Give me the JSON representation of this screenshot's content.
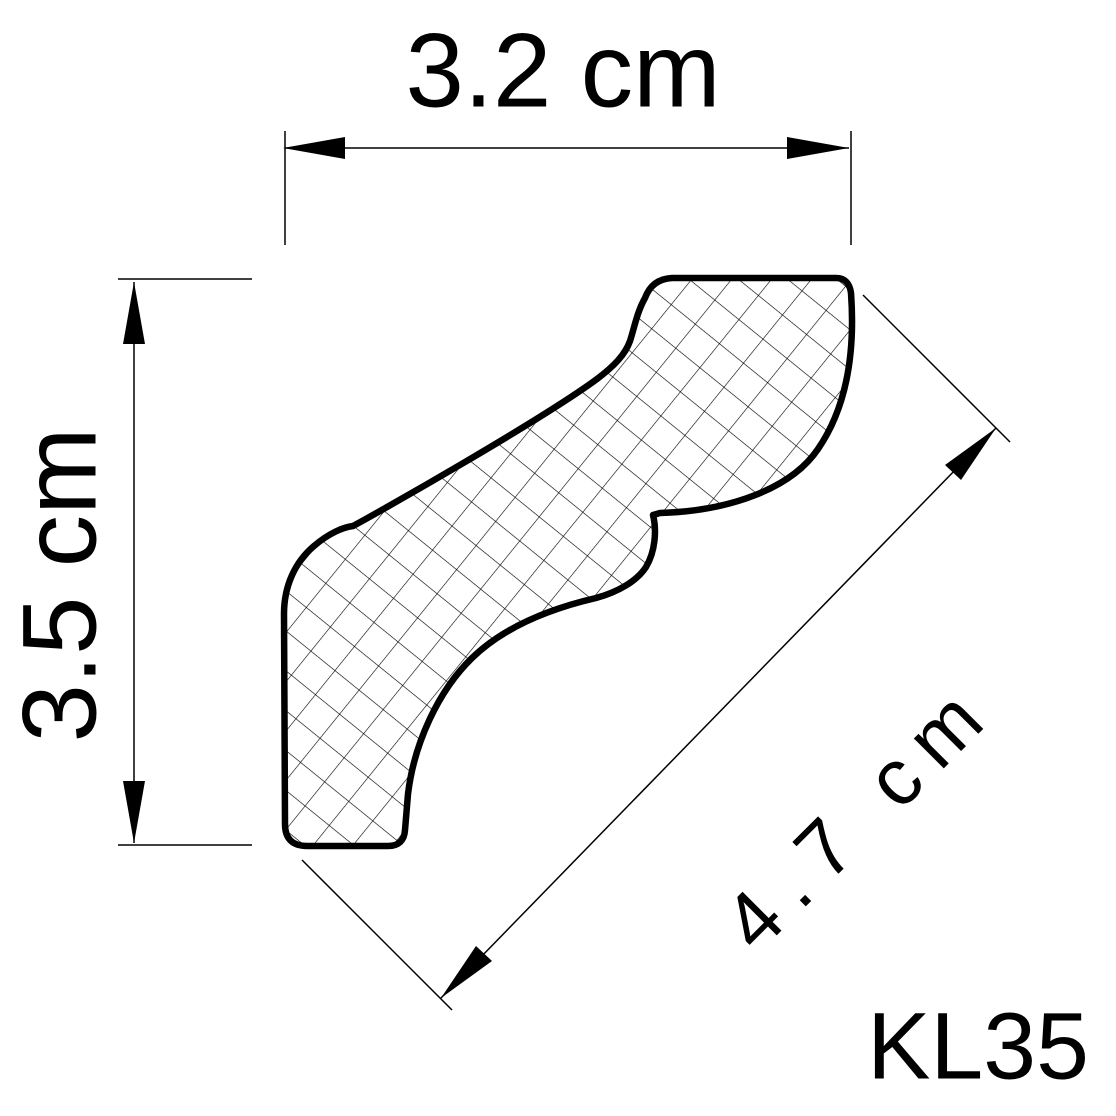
{
  "drawing": {
    "product_code": "KL35",
    "type": "coving-profile-cross-section",
    "dimensions": {
      "width_label": "3.2 cm",
      "height_label": "3.5 cm",
      "diagonal_label": "4.7 cm"
    },
    "colors": {
      "ink": "#000000",
      "background": "#ffffff"
    },
    "hatch": {
      "style": "diagonal-crosshatch",
      "spacing_px": 31,
      "angle_deg": 39
    }
  }
}
